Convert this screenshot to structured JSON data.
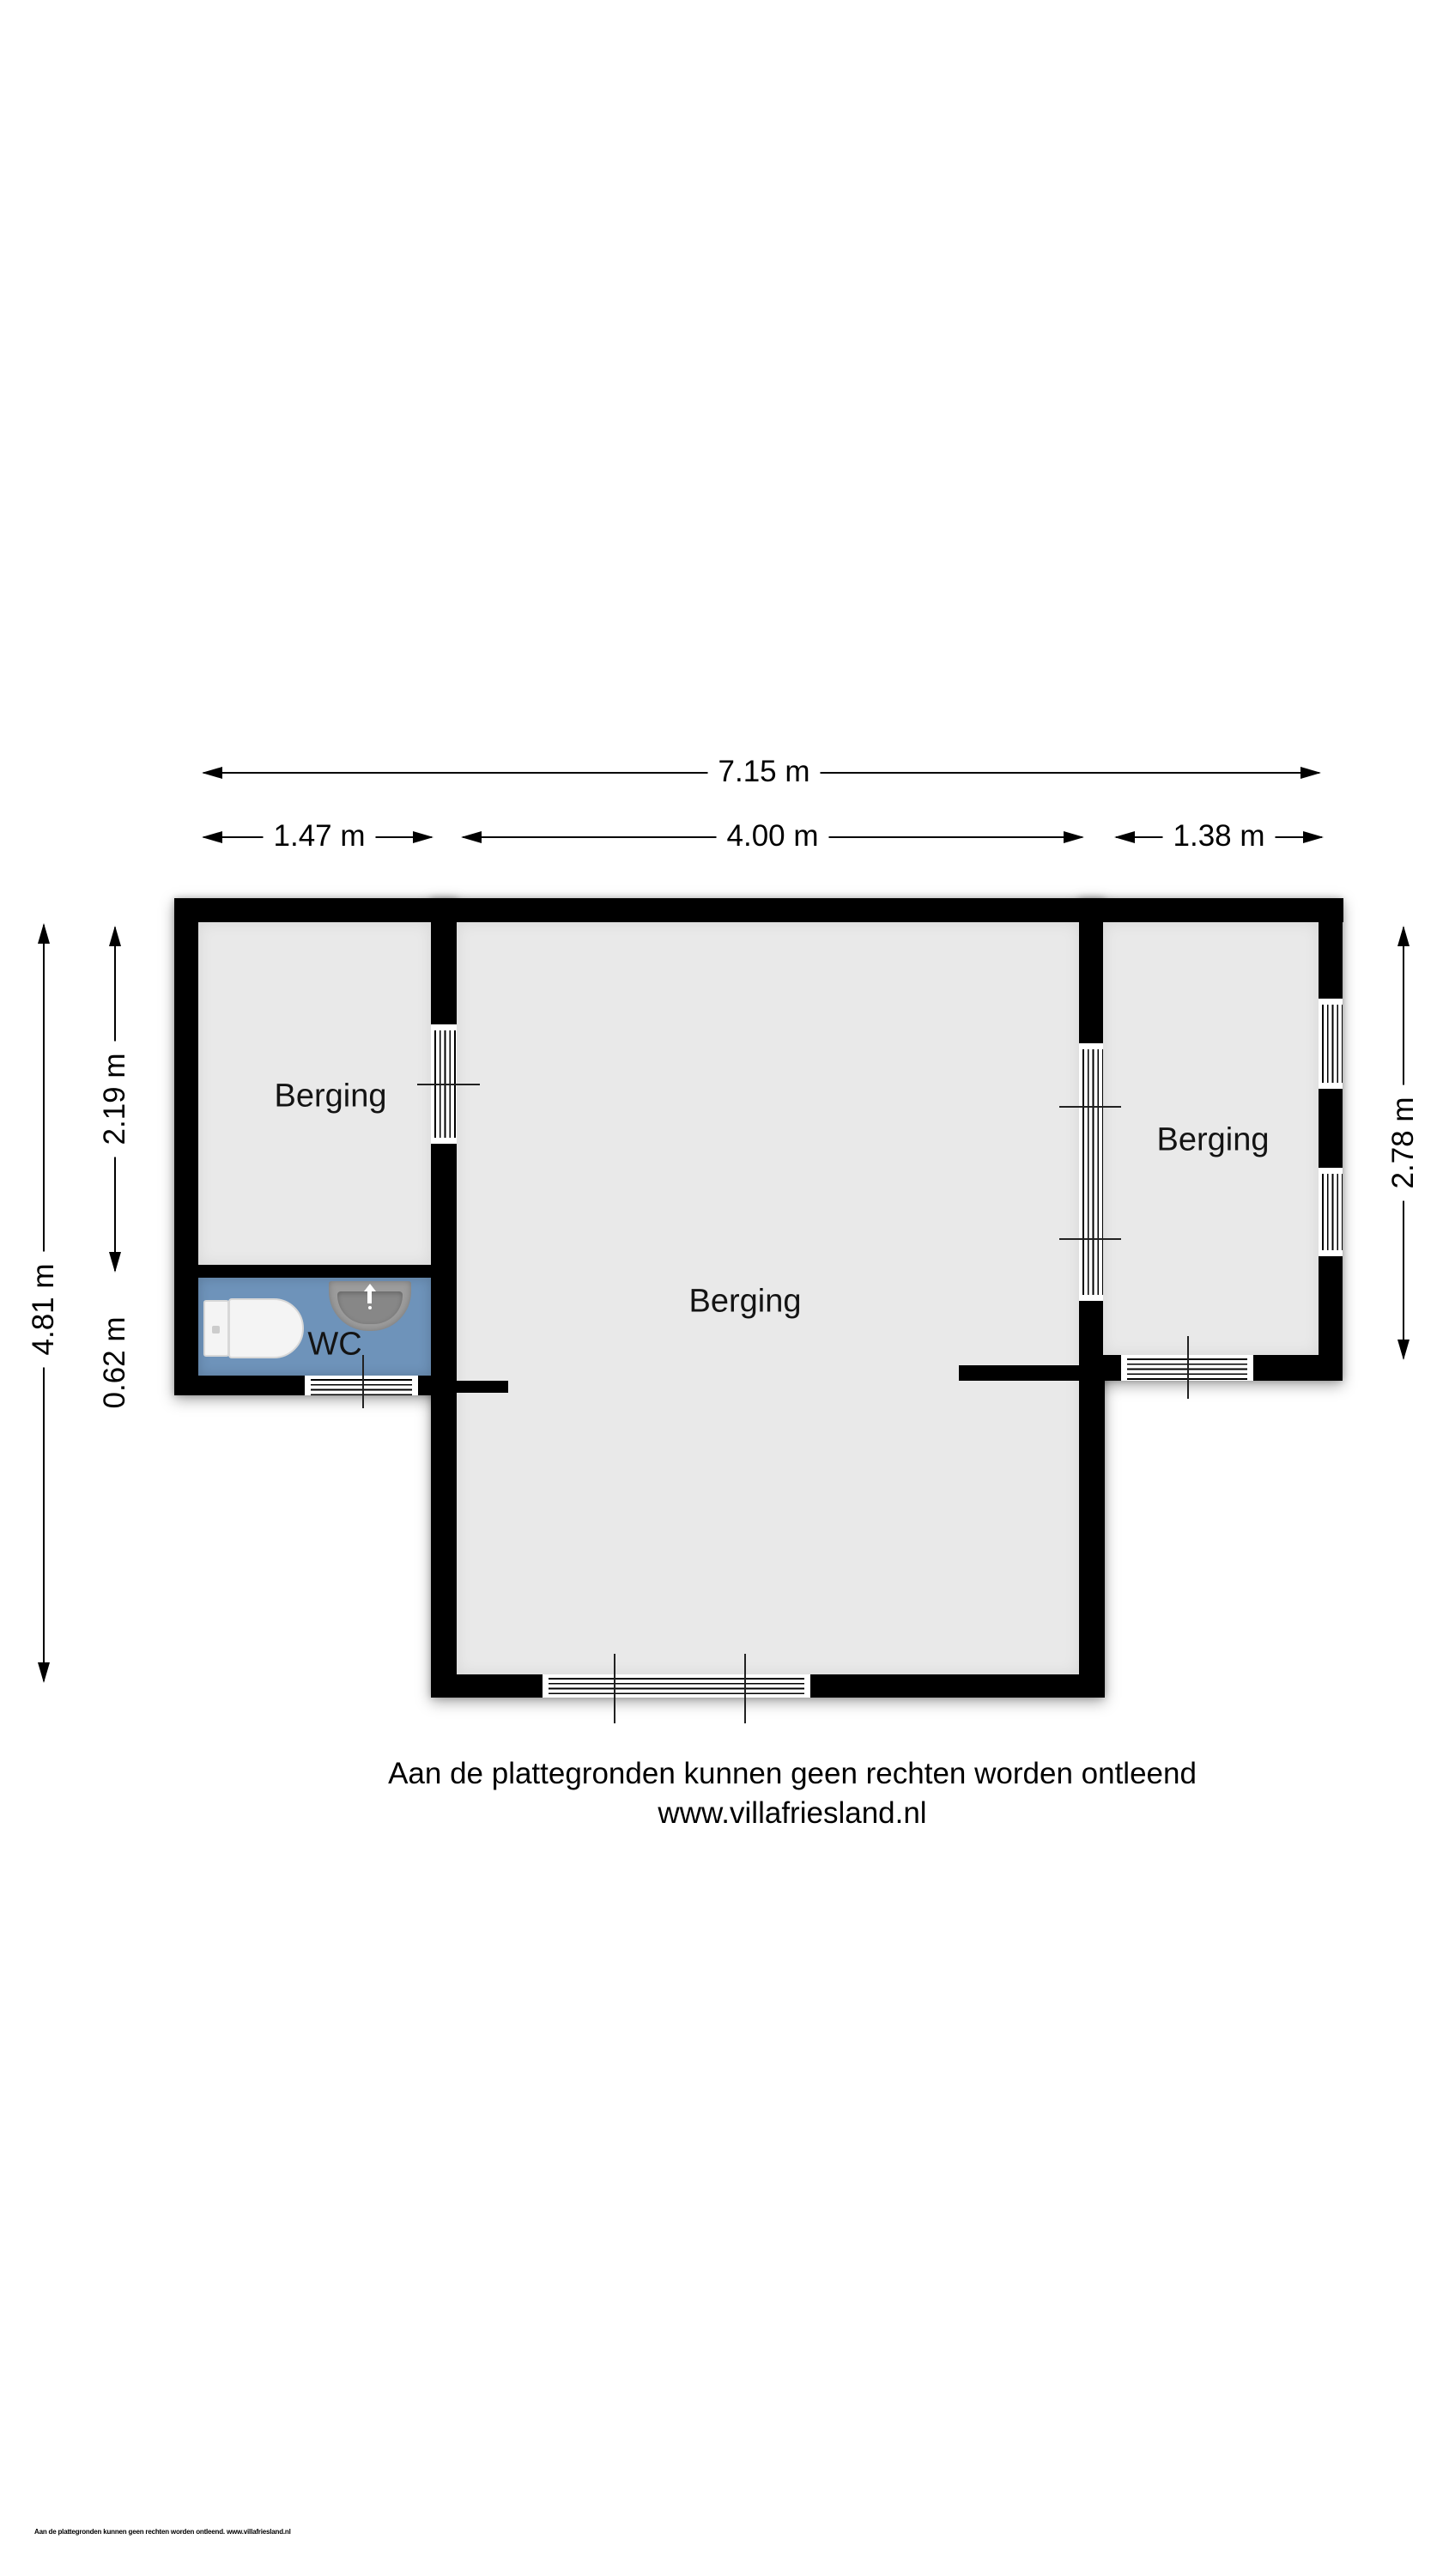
{
  "rooms": [
    {
      "label": "Berging",
      "area": "left"
    },
    {
      "label": "Berging",
      "area": "center"
    },
    {
      "label": "Berging",
      "area": "right"
    },
    {
      "label": "WC",
      "area": "wc"
    }
  ],
  "dimensions": {
    "total_width": "7.15 m",
    "left_width": "1.47 m",
    "center_width": "4.00 m",
    "right_width": "1.38 m",
    "total_height": "4.81 m",
    "left_room_height": "2.19 m",
    "wc_height": "0.62 m",
    "right_room_height": "2.78 m"
  },
  "disclaimer": "Aan de plattegronden kunnen geen rechten worden ontleend",
  "website": "www.villafriesland.nl",
  "footer_note": "Aan de plattegronden kunnen geen rechten worden ontleend. www.villafriesland.nl",
  "colors": {
    "wall": "#000000",
    "floor": "#e9e9e9",
    "wc_floor": "#6e93ba",
    "background": "#ffffff",
    "text": "#111111"
  }
}
